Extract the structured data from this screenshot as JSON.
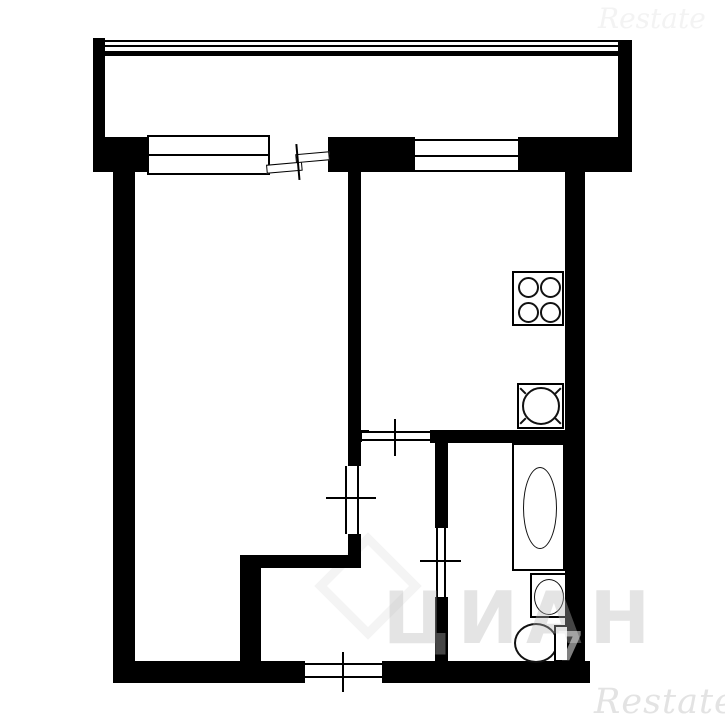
{
  "watermarks": {
    "restate_bottom": "Restate",
    "restate_top": "Restate",
    "agency_center": "ЦИАН",
    "wall_digit": "7"
  },
  "colors": {
    "wall": "#000000",
    "background": "#ffffff",
    "fixture_line": "#111111",
    "watermark_gray": "#e3e3e3"
  },
  "fixtures": {
    "stove": "stove-4-burner-icon",
    "kitchen_sink": "kitchen-sink-icon",
    "bathtub": "bathtub-icon",
    "washbasin": "washbasin-icon",
    "toilet": "toilet-icon"
  },
  "openings": {
    "windows": [
      "living-room-window",
      "kitchen-window"
    ],
    "doors": [
      "balcony-door",
      "living-room-door",
      "kitchen-door",
      "bathroom-door",
      "entrance-door"
    ]
  }
}
